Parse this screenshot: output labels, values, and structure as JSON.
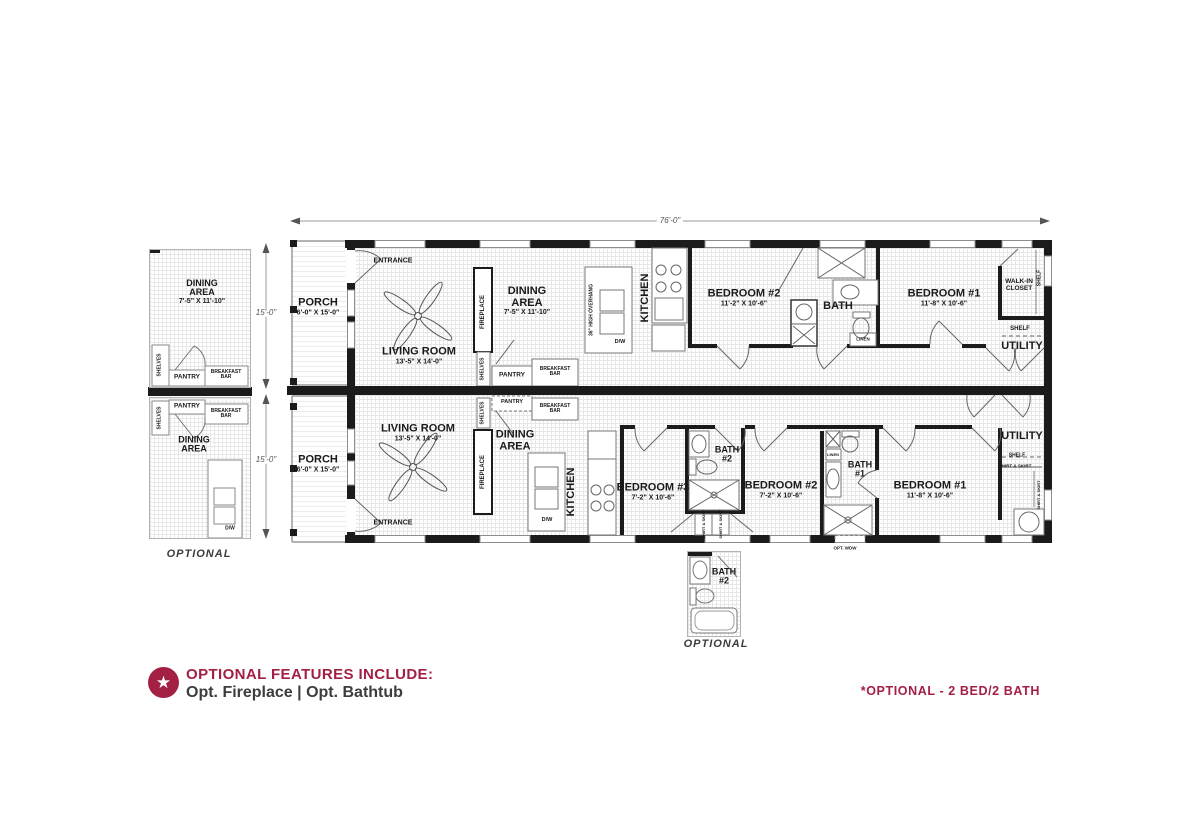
{
  "colors": {
    "accent": "#A32044",
    "wall": "#1B1B1B",
    "line": "#666666",
    "grid": "#E7E7E7"
  },
  "dimensions": {
    "overall_width": "76'-0\"",
    "upper_height": "15'-0\"",
    "lower_height": "15'-0\""
  },
  "icons": {
    "star": "★"
  },
  "footer": {
    "headline": "OPTIONAL FEATURES INCLUDE:",
    "features": "Opt. Fireplace | Opt. Bathtub",
    "note": "*OPTIONAL - 2 BED/2 BATH"
  },
  "detail_top": {
    "room_l1": "DINING",
    "room_l2": "AREA",
    "dims": "7'-5\" X 11'-10\"",
    "shelves": "SHELVES",
    "pantry": "PANTRY",
    "breakfast_bar_l1": "BREAKFAST",
    "breakfast_bar_l2": "BAR"
  },
  "detail_bottom": {
    "pantry": "PANTRY",
    "shelves": "SHELVES",
    "breakfast_bar_l1": "BREAKFAST",
    "breakfast_bar_l2": "BAR",
    "room_l1": "DINING",
    "room_l2": "AREA",
    "dw": "D/W",
    "caption": "OPTIONAL"
  },
  "detail_bath": {
    "name_l1": "BATH",
    "name_l2": "#2",
    "caption": "OPTIONAL"
  },
  "plan_top": {
    "entrance": "ENTRANCE",
    "porch": "PORCH",
    "porch_dims": "6'-0\" X 15'-0\"",
    "living": "LIVING ROOM",
    "living_dims": "13'-5\" X 14'-0\"",
    "fireplace": "FIREPLACE",
    "shelves": "SHELVES",
    "pantry": "PANTRY",
    "breakfast_bar_l1": "BREAKFAST",
    "breakfast_bar_l2": "BAR",
    "dining_l1": "DINING",
    "dining_l2": "AREA",
    "dining_dims": "7'-5\" X 11'-10\"",
    "overhang": "36\" HIGH OVERHANG",
    "dw": "D/W",
    "kitchen": "KITCHEN",
    "bedroom2": "BEDROOM #2",
    "bedroom2_dims": "11'-2\" X 10'-6\"",
    "bath": "BATH",
    "linen": "LINEN",
    "bedroom1": "BEDROOM #1",
    "bedroom1_dims": "11'-8\" X 10'-6\"",
    "walkin_l1": "WALK-IN",
    "walkin_l2": "CLOSET",
    "shelf_side": "SHELF",
    "shelf": "SHELF",
    "utility": "UTILITY"
  },
  "plan_bottom": {
    "entrance": "ENTRANCE",
    "porch": "PORCH",
    "porch_dims": "6'-0\" X 15'-0\"",
    "living": "LIVING ROOM",
    "living_dims": "13'-5\" X 14'-0\"",
    "fireplace": "FIREPLACE",
    "shelves": "SHELVES",
    "pantry": "PANTRY",
    "breakfast_bar_l1": "BREAKFAST",
    "breakfast_bar_l2": "BAR",
    "dining_l1": "DINING",
    "dining_l2": "AREA",
    "dw": "D/W",
    "kitchen": "KITCHEN",
    "bedroom3": "BEDROOM #3",
    "bedroom3_dims": "7'-2\" X 10'-6\"",
    "bath2_l1": "BATH",
    "bath2_l2": "#2",
    "shirt_skirt": "SHIRT & SKIRT",
    "bedroom2": "BEDROOM #2",
    "bedroom2_dims": "7'-2\" X 10'-6\"",
    "linen": "LINEN",
    "bath1_l1": "BATH",
    "bath1_l2": "#1",
    "opt_wdw": "OPT. WDW",
    "bedroom1": "BEDROOM #1",
    "bedroom1_dims": "11'-8\" X 10'-6\"",
    "utility": "UTILITY",
    "shelf": "SHELF"
  }
}
